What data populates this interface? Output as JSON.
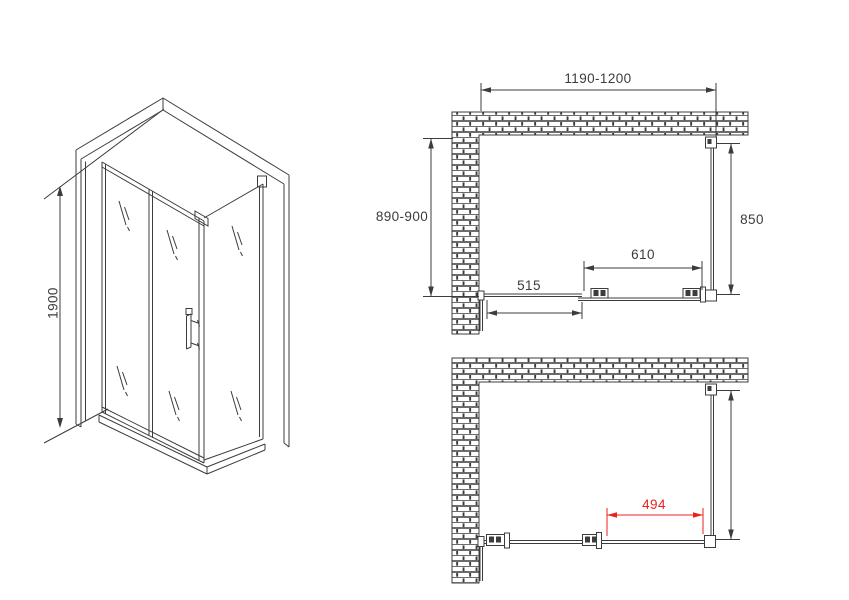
{
  "colors": {
    "line": "#3c3c3c",
    "dimension_red": "#e8231c",
    "background": "#ffffff"
  },
  "isometric_view": {
    "height_dimension": "1900"
  },
  "plan_view_closed": {
    "overall_width": "1190-1200",
    "depth_left": "890-900",
    "depth_right": "850",
    "sliding_door_width": "610",
    "fixed_panel_width": "515"
  },
  "plan_view_open": {
    "door_opening_width": "494"
  }
}
